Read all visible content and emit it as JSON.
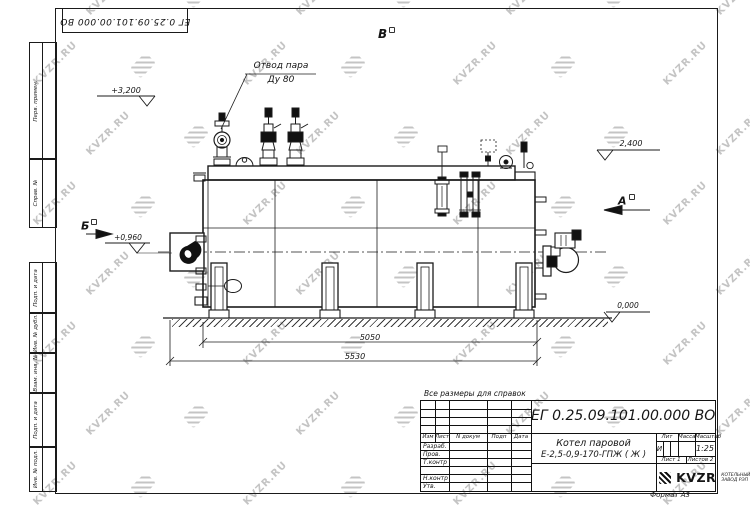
{
  "watermark": {
    "text": "KVZR.RU"
  },
  "stamp_top": "ЕГ 0.25.09.101.00.000  ВО",
  "margin_labels": [
    "Перв. примен.",
    "Справ. №",
    "Подп. и дата",
    "Инв. № дубл.",
    "Взам. инв. №",
    "Подп. и дата",
    "Инв. № подл."
  ],
  "drawing": {
    "callout_line1": "Отвод пара",
    "callout_line2": "Ду 80",
    "level_top": "+3,200",
    "level_drum": "2,400",
    "level_burner": "+0,960",
    "level_ground": "0,000",
    "view_top": "В",
    "view_front": "Б",
    "view_rear": "А",
    "dim_inner": "5050",
    "dim_overall": "5530"
  },
  "note": "Все размеры для справок",
  "title_block": {
    "doc_number": "ЕГ 0.25.09.101.00.000  ВО",
    "cols": [
      "Изм",
      "Лист",
      "N докум",
      "Подп",
      "Дата"
    ],
    "row_labels": [
      "Разраб.",
      "Пров.",
      "Т.контр",
      "Н.контр",
      "Утв."
    ],
    "product_line1": "Котел паровой",
    "product_line2": "Е-2,5-0,9-170-ГПЖ ( Ж )",
    "lit_label": "Лит",
    "lit_value": "И",
    "mass_label": "Масса",
    "scale_label": "Масштаб",
    "scale_value": "1:25",
    "sheet_label": "Лист",
    "sheet_value": "1",
    "sheets_label": "Листов",
    "sheets_value": "2",
    "logo_text": "KVZR",
    "logo_caption1": "КОТЕЛЬНЫЙ",
    "logo_caption2": "ЗАВОД РЭП",
    "format_label": "Формат А3"
  }
}
